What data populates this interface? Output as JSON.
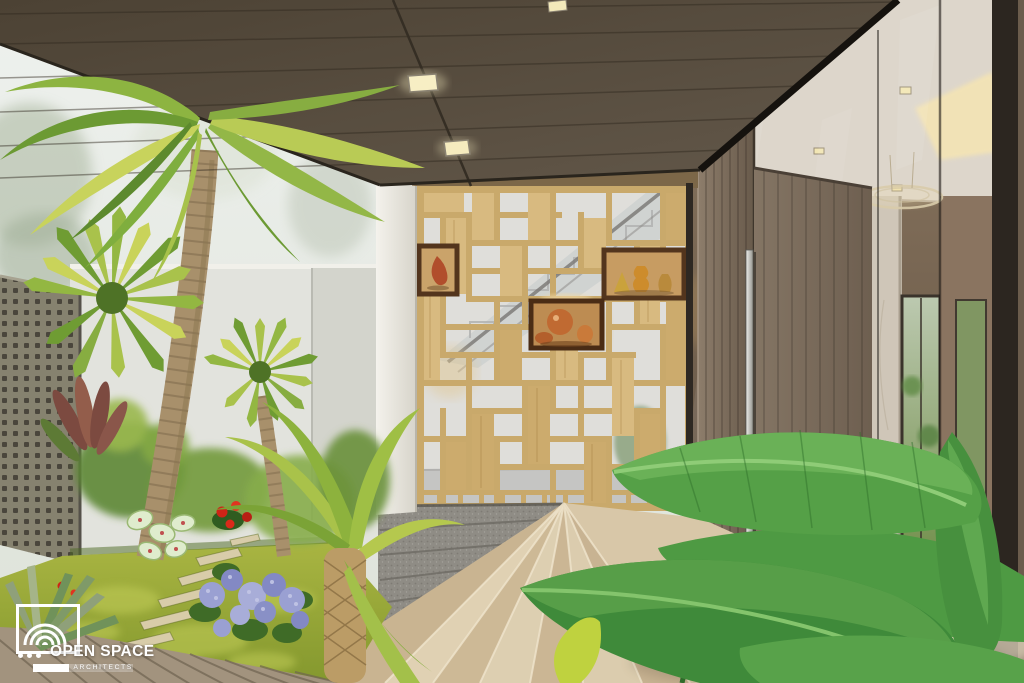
{
  "logo": {
    "dots": "...",
    "brand": "OPEN SPACE",
    "sub": "ARCHITECTS",
    "color": "#ffffff"
  },
  "palette": {
    "soffit_brown": "#55493a",
    "screen_wood": "#c9a96b",
    "marble_beige": "#d8c7a8",
    "granite_grey": "#8f8c85",
    "door_wood": "#7b6b5b",
    "handle_steel": "#d9d9d5",
    "foliage_green": "#7fae3e",
    "grass_green": "#9cab3b",
    "hydrangea_purple": "#9aa0d2",
    "vase_copper": "#c06a32",
    "interior_warm": "#6e5947",
    "white_wall": "#e2e3dd"
  },
  "scene": {
    "elements": [
      "tropical courtyard garden",
      "fan palms and leaning palm trunk",
      "perforated concrete lattice wall",
      "decorative timber partition screen with display niches",
      "copper and amber vases in dark timber boxes",
      "staircase seen through the screen",
      "fanning beige marble entry steps",
      "speckled granite plinth",
      "grey timber pivot door with long steel pull handle",
      "glass curtain wall with reflections",
      "interior lobby: marble column, ring chandelier, bronze wall panels, garden window",
      "dark timber soffit ceiling with recessed square spotlights",
      "banana leaves in the foreground",
      "stepping stones, lawn and timber deck",
      "hydrangeas, caladiums and red tropical flowers"
    ]
  }
}
